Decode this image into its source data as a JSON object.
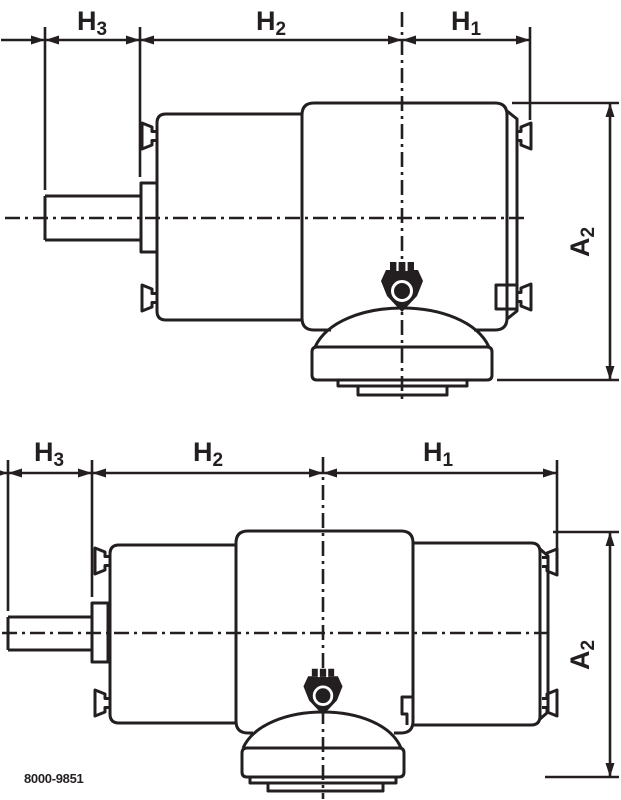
{
  "drawing": {
    "figure_number": "8000-9851",
    "line_color": "#231f20",
    "background_color": "#ffffff",
    "labels": {
      "h1": {
        "base": "H",
        "sub": "1"
      },
      "h2": {
        "base": "H",
        "sub": "2"
      },
      "h3": {
        "base": "H",
        "sub": "3"
      },
      "a2": {
        "base": "A",
        "sub": "2"
      }
    },
    "views": [
      {
        "name": "upper-view",
        "description": "Side view of foot-mounted gear motor, single reduction stage",
        "dimensions_shown": [
          "H3",
          "H2",
          "H1",
          "A2"
        ]
      },
      {
        "name": "lower-view",
        "description": "Side view of foot-mounted gear motor, double reduction stage",
        "dimensions_shown": [
          "H3",
          "H2",
          "H1",
          "A2"
        ]
      }
    ]
  }
}
